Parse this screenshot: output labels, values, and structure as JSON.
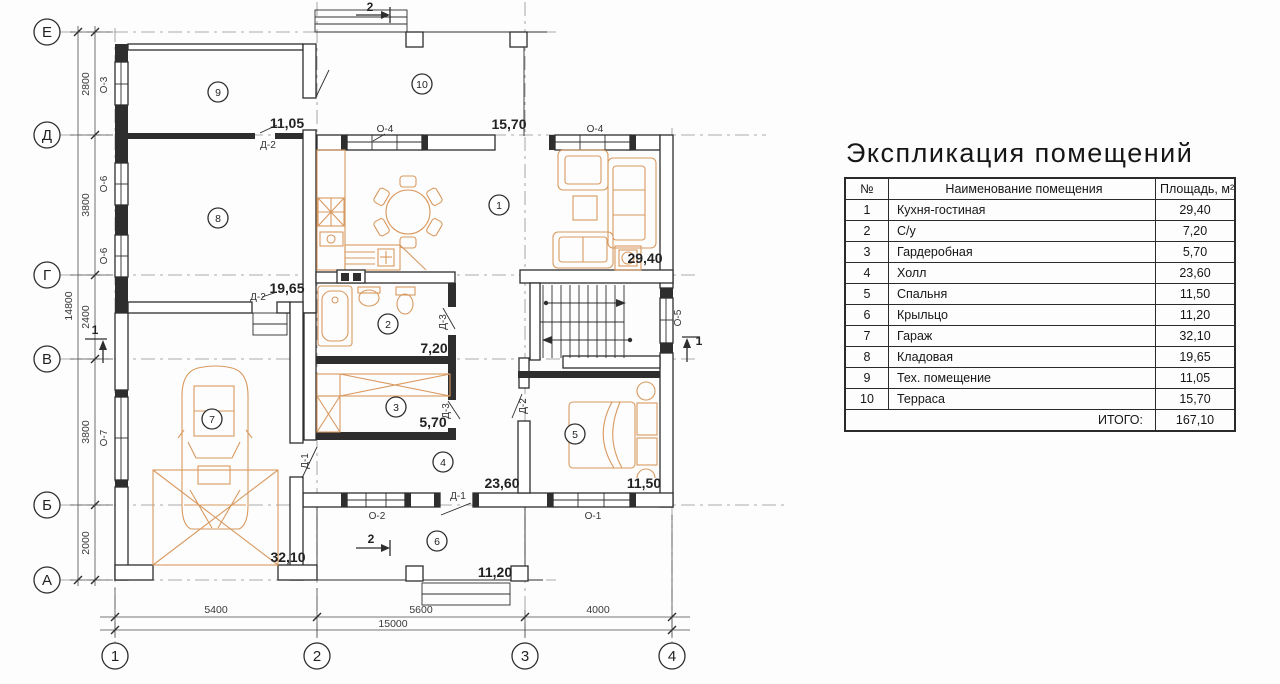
{
  "plan": {
    "row_axes": [
      "Е",
      "Д",
      "Г",
      "В",
      "Б",
      "А"
    ],
    "col_axes": [
      "1",
      "2",
      "3",
      "4"
    ],
    "left_dims": [
      "2800",
      "3800",
      "2400",
      "3800",
      "2000"
    ],
    "left_total": "14800",
    "bottom_dims": [
      "5400",
      "5600",
      "4000"
    ],
    "bottom_total": "15000",
    "rooms": [
      {
        "num": "1",
        "area": "29,40"
      },
      {
        "num": "2",
        "area": "7,20"
      },
      {
        "num": "3",
        "area": "5,70"
      },
      {
        "num": "4",
        "area": "23,60"
      },
      {
        "num": "5",
        "area": "11,50"
      },
      {
        "num": "6",
        "area": "11,20"
      },
      {
        "num": "7",
        "area": "32,10"
      },
      {
        "num": "8",
        "area": "19,65"
      },
      {
        "num": "9",
        "area": "11,05"
      },
      {
        "num": "10",
        "area": "15,70"
      }
    ],
    "win": {
      "o1": "О-1",
      "o2": "О-2",
      "o3": "О-3",
      "o4": "О-4",
      "o5": "О-5",
      "o6": "О-6",
      "o7": "О-7"
    },
    "door": {
      "d1": "Д-1",
      "d2": "Д-2",
      "d3": "Д-3"
    },
    "sec": {
      "s1": "1",
      "s2": "2"
    }
  },
  "table": {
    "title": "Экспликация помещений",
    "headers": {
      "num": "№",
      "name": "Наименование помещения",
      "area": "Площадь, м²"
    },
    "rows": [
      {
        "n": "1",
        "name": "Кухня-гостиная",
        "a": "29,40"
      },
      {
        "n": "2",
        "name": "С/у",
        "a": "7,20"
      },
      {
        "n": "3",
        "name": "Гардеробная",
        "a": "5,70"
      },
      {
        "n": "4",
        "name": "Холл",
        "a": "23,60"
      },
      {
        "n": "5",
        "name": "Спальня",
        "a": "11,50"
      },
      {
        "n": "6",
        "name": "Крыльцо",
        "a": "11,20"
      },
      {
        "n": "7",
        "name": "Гараж",
        "a": "32,10"
      },
      {
        "n": "8",
        "name": "Кладовая",
        "a": "19,65"
      },
      {
        "n": "9",
        "name": "Тех. помещение",
        "a": "11,05"
      },
      {
        "n": "10",
        "name": "Терраса",
        "a": "15,70"
      }
    ],
    "total_label": "ИТОГО:",
    "total_value": "167,10"
  }
}
